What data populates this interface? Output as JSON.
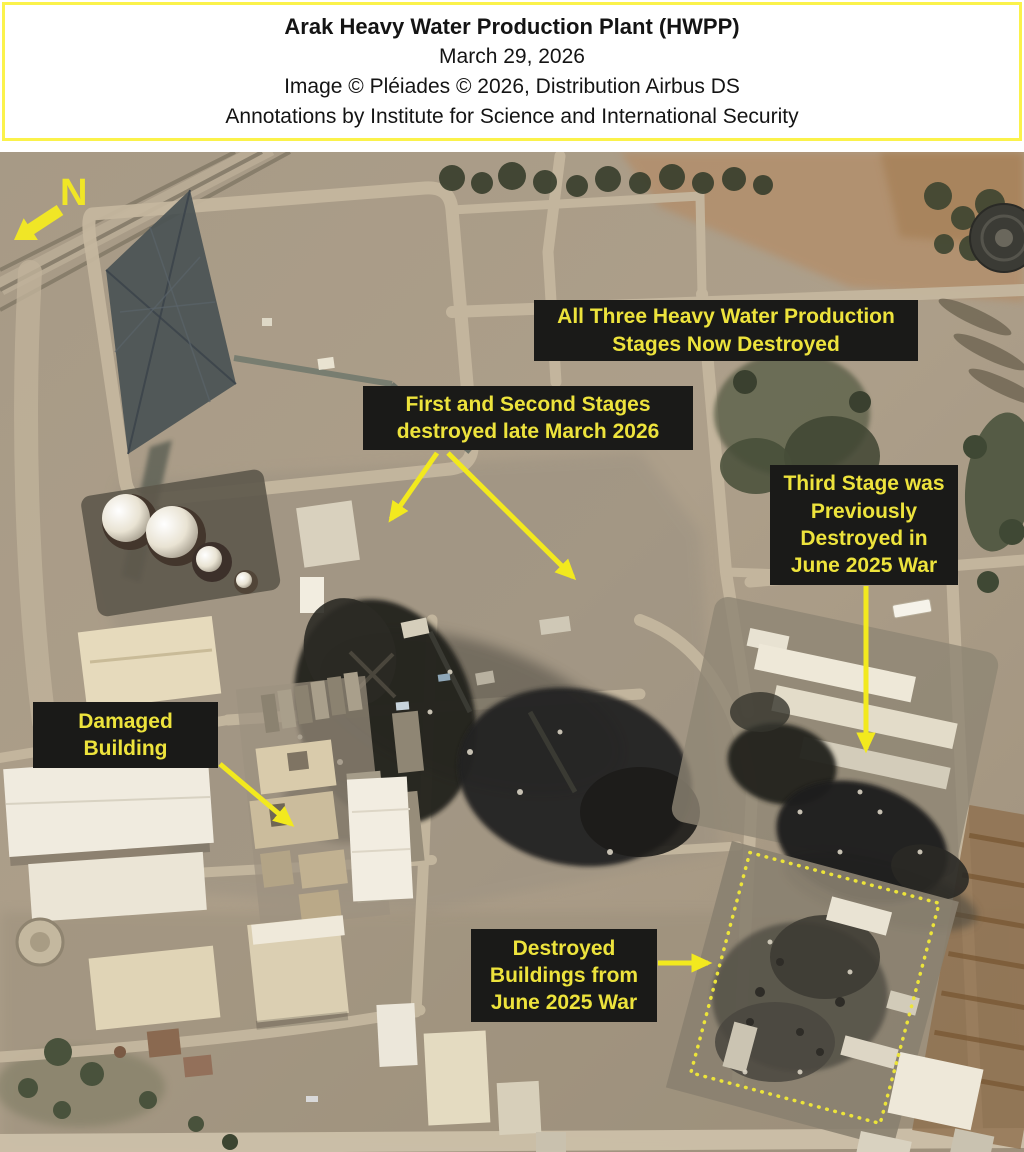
{
  "header": {
    "title": "Arak Heavy Water Production Plant (HWPP)",
    "date": "March 29, 2026",
    "credit": "Image © Pléiades © 2026, Distribution Airbus DS",
    "annotations_credit": "Annotations by Institute for Science and International Security"
  },
  "map": {
    "north_label": "N",
    "callouts": {
      "all_three_stages": {
        "lines": [
          "All Three Heavy Water Production",
          "Stages Now Destroyed"
        ]
      },
      "first_second_stages": {
        "lines": [
          "First and Second Stages",
          "destroyed late March 2026"
        ]
      },
      "third_stage": {
        "lines": [
          "Third Stage was",
          "Previously",
          "Destroyed in",
          "June 2025 War"
        ]
      },
      "damaged_building": {
        "lines": [
          "Damaged",
          "Building"
        ]
      },
      "destroyed_buildings": {
        "lines": [
          "Destroyed",
          "Buildings from",
          "June 2025 War"
        ]
      }
    },
    "icons": {
      "north_arrow": "thick-arrow-pointing-lower-left",
      "highlight_box": "yellow-dotted-rotated-rectangle"
    }
  },
  "colors": {
    "annotation_yellow": "#ede33c",
    "arrow_yellow": "#f2e91e",
    "callout_background": "#1a1a18",
    "header_border": "#fbf24b"
  }
}
